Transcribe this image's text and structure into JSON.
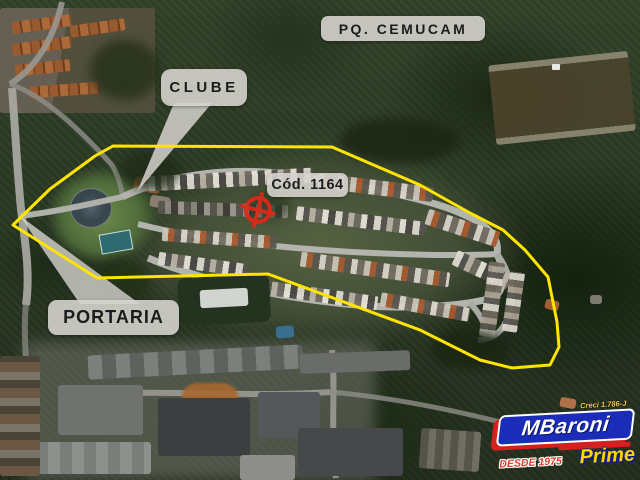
{
  "map": {
    "park_label": "PQ. CEMUCAM",
    "clube_label": "CLUBE",
    "portaria_label": "PORTARIA",
    "code_label": "Cód. 1164"
  },
  "logo": {
    "creci": "Creci 1.786-J",
    "brand": "MBaroni",
    "desde": "DESDE 1975",
    "prime": "Prime"
  },
  "icons": {
    "target_marker": "crosshair-circle-icon"
  },
  "colors": {
    "boundary": "#ffe400",
    "target": "#e02818",
    "label_bg": "#d5d3cd",
    "logo_blue": "#1b2cb8",
    "logo_red": "#d62020",
    "logo_yellow": "#ffd400"
  }
}
